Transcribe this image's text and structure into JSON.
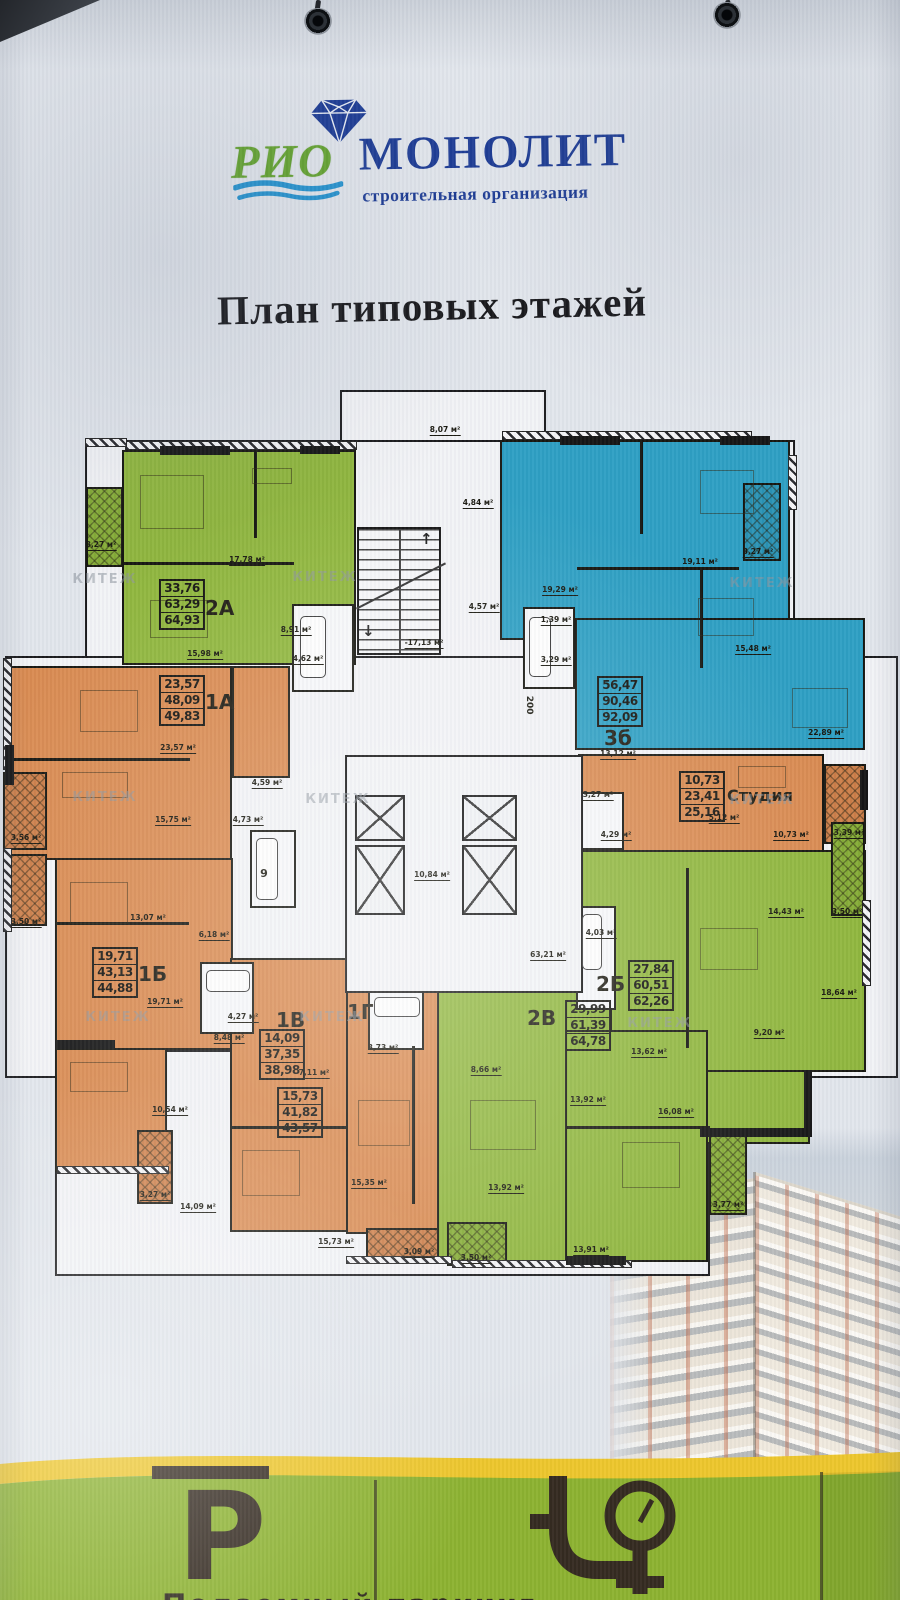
{
  "brand": {
    "name_top": "РИО",
    "name_main": "МОНОЛИТ",
    "subtitle": "строительная организация"
  },
  "page_title": "План типовых этажей",
  "watermark": "КИТЕЖ",
  "apartments": [
    {
      "id": "2a",
      "label": "2А",
      "values": [
        "33,76",
        "63,29",
        "64,93"
      ]
    },
    {
      "id": "1a",
      "label": "1А",
      "values": [
        "23,57",
        "48,09",
        "49,83"
      ]
    },
    {
      "id": "3b",
      "label": "3б",
      "values": [
        "56,47",
        "90,46",
        "92,09"
      ]
    },
    {
      "id": "studio",
      "label": "Студия",
      "values": [
        "10,73",
        "23,41",
        "25,16"
      ]
    },
    {
      "id": "1b",
      "label": "1Б",
      "values": [
        "19,71",
        "43,13",
        "44,88"
      ]
    },
    {
      "id": "2b",
      "label": "2Б",
      "values": [
        "27,84",
        "60,51",
        "62,26"
      ]
    },
    {
      "id": "2v",
      "label": "2В",
      "values": [
        "29,99",
        "61,39",
        "64,78"
      ]
    },
    {
      "id": "1v",
      "label": "1В",
      "values": [
        "14,09",
        "37,35",
        "38,98"
      ]
    },
    {
      "id": "1g",
      "label": "1Г",
      "values": [
        "15,73",
        "41,82",
        "43,57"
      ]
    }
  ],
  "room_labels": [
    {
      "t": "17,78 м²"
    },
    {
      "t": "15,98 м²"
    },
    {
      "t": "8,91 м²"
    },
    {
      "t": "4,62 м²"
    },
    {
      "t": "3,27 м²"
    },
    {
      "t": "8,07 м²"
    },
    {
      "t": "4,84 м²"
    },
    {
      "t": "4,57 м²"
    },
    {
      "t": "-17,13 м²"
    },
    {
      "t": "19,29 м²"
    },
    {
      "t": "19,11 м²"
    },
    {
      "t": "15,48 м²"
    },
    {
      "t": "22,89 м²"
    },
    {
      "t": "13,12 м²"
    },
    {
      "t": "3,27 м²"
    },
    {
      "t": "1,39 м²"
    },
    {
      "t": "3,29 м²"
    },
    {
      "t": "23,57 м²"
    },
    {
      "t": "15,75 м²"
    },
    {
      "t": "4,59 м²"
    },
    {
      "t": "4,73 м²"
    },
    {
      "t": "3,56 м²"
    },
    {
      "t": "3,50 м²"
    },
    {
      "t": "9"
    },
    {
      "t": "63,21 м²"
    },
    {
      "t": "10,84 м²"
    },
    {
      "t": "19,71 м²"
    },
    {
      "t": "13,07 м²"
    },
    {
      "t": "10,54 м²"
    },
    {
      "t": "14,09 м²"
    },
    {
      "t": "3,27 м²"
    },
    {
      "t": "6,18 м²"
    },
    {
      "t": "4,27 м²"
    },
    {
      "t": "8,48 м²"
    },
    {
      "t": "7,11 м²"
    },
    {
      "t": "3,73 м²"
    },
    {
      "t": "15,35 м²"
    },
    {
      "t": "15,73 м²"
    },
    {
      "t": "3,09 м²"
    },
    {
      "t": "8,66 м²"
    },
    {
      "t": "13,92 м²"
    },
    {
      "t": "16,08 м²"
    },
    {
      "t": "13,92 м²"
    },
    {
      "t": "13,91 м²"
    },
    {
      "t": "3,77 м²"
    },
    {
      "t": "3,50 м²"
    },
    {
      "t": "14,43 м²"
    },
    {
      "t": "18,64 м²"
    },
    {
      "t": "9,20 м²"
    },
    {
      "t": "4,03 м²"
    },
    {
      "t": "3,50 м²"
    },
    {
      "t": "13,62 м²"
    },
    {
      "t": "3,27 м²"
    },
    {
      "t": "5,12 м²"
    },
    {
      "t": "10,73 м²"
    },
    {
      "t": "4,29 м²"
    },
    {
      "t": "3,39 м²"
    },
    {
      "t": "200"
    }
  ],
  "footer": {
    "parking_symbol": "Р",
    "caption": "Подземный паркинг"
  },
  "colors": {
    "apartment_green": "#8fb63c",
    "apartment_orange": "#d98a50",
    "apartment_blue": "#2d9fc3",
    "brand_navy": "#1c3b94",
    "brand_green": "#64a42e",
    "footer_green": "#8cb22f",
    "footer_yellow": "#edc62b"
  }
}
